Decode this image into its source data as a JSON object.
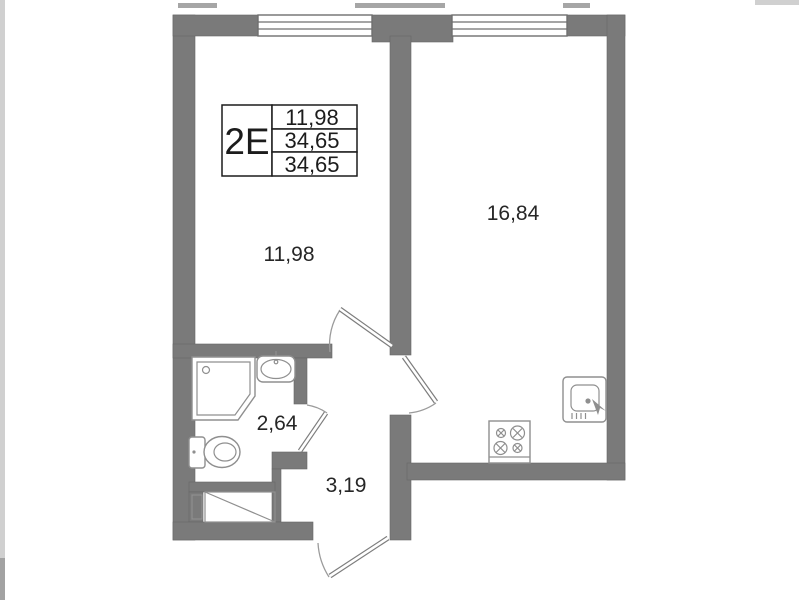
{
  "legend": {
    "unit_type": "2Е",
    "row1": "11,98",
    "row2": "34,65",
    "row3": "34,65"
  },
  "rooms": {
    "living": {
      "area": "11,98"
    },
    "kitchen": {
      "area": "16,84"
    },
    "bathroom": {
      "area": "2,64"
    },
    "hallway": {
      "area": "3,19"
    }
  },
  "fixtures": {
    "shower": "shower-tray-icon",
    "washbasin": "washbasin-icon",
    "toilet": "toilet-icon",
    "wardrobe": "wardrobe-diagonal-icon",
    "stove": "stove-4-burner-icon",
    "kitchen_sink": "kitchen-sink-icon",
    "windows": "window-symbol",
    "doors": "door-swing-symbol"
  },
  "colors": {
    "wall": "#7a7a7a",
    "fixture_line": "#8f8f8f",
    "text": "#262626",
    "background": "#ffffff"
  }
}
